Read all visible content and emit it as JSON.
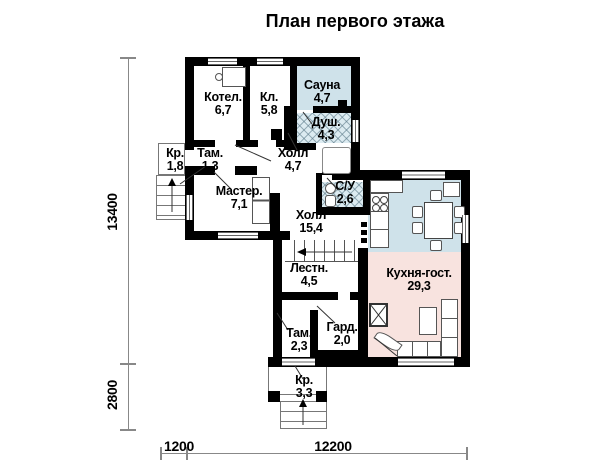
{
  "title": "План первого этажа",
  "rooms": [
    {
      "name": "Котел.",
      "area": "6,7"
    },
    {
      "name": "Кл.",
      "area": "5,8"
    },
    {
      "name": "Сауна",
      "area": "4,7"
    },
    {
      "name": "Душ.",
      "area": "4,3"
    },
    {
      "name": "Кр.",
      "area": "1,8"
    },
    {
      "name": "Там.",
      "area": "1,3"
    },
    {
      "name": "Холл",
      "area": "4,7"
    },
    {
      "name": "Мастер.",
      "area": "7,1"
    },
    {
      "name": "С/У",
      "area": "2,6"
    },
    {
      "name": "Холл",
      "area": "15,4"
    },
    {
      "name": "Лестн.",
      "area": "4,5"
    },
    {
      "name": "Кухня-гост.",
      "area": "29,3"
    },
    {
      "name": "Там.",
      "area": "2,3"
    },
    {
      "name": "Гард.",
      "area": "2,0"
    },
    {
      "name": "Кр.",
      "area": "3,3"
    }
  ],
  "dimensions": {
    "left_upper": "13400",
    "left_lower": "2800",
    "bottom_left": "1200",
    "bottom_right": "12200"
  },
  "colors": {
    "wall": "#000000",
    "sauna_kitchen_fill": "#cfe2ea",
    "living_fill": "#f8e3df",
    "wet_hatch_fill": "#dcebf1"
  }
}
